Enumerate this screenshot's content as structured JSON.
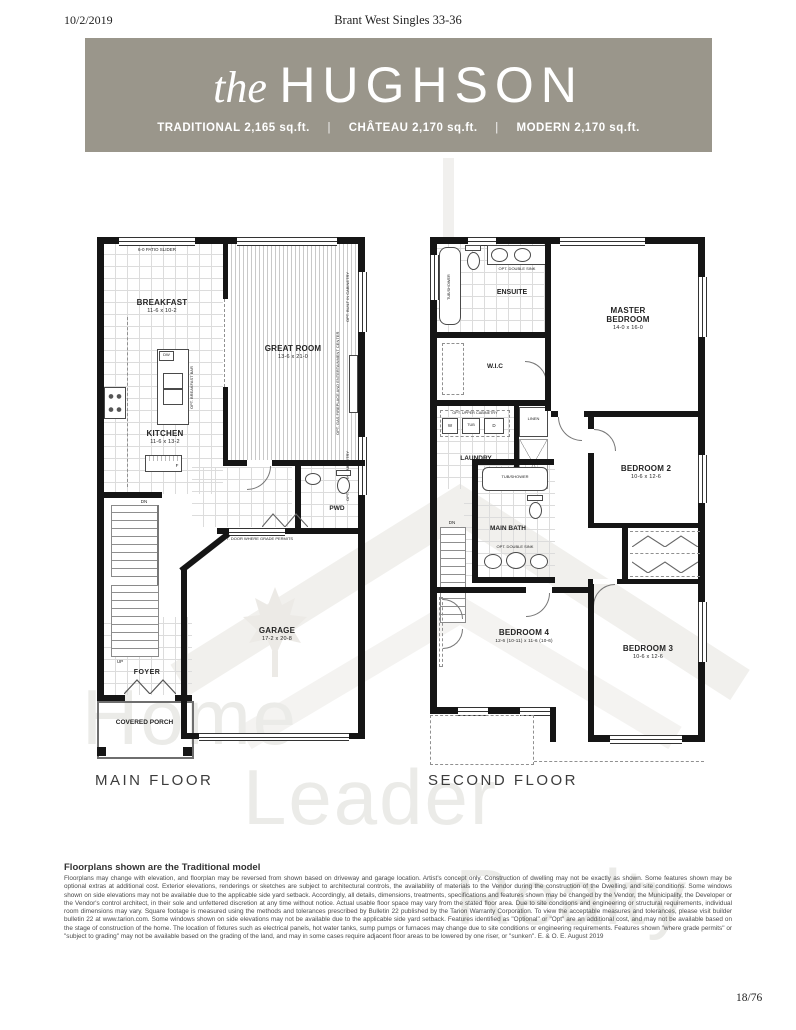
{
  "page": {
    "date": "10/2/2019",
    "header_title": "Brant West Singles 33-36",
    "page_number": "18/76"
  },
  "banner": {
    "title_prefix": "the",
    "title": "HUGHSON",
    "separator": "|",
    "bg_color": "#9a968b",
    "models": [
      {
        "label": "TRADITIONAL",
        "sqft": "2,165 sq.ft."
      },
      {
        "label": "CHÂTEAU",
        "sqft": "2,170 sq.ft."
      },
      {
        "label": "MODERN",
        "sqft": "2,170 sq.ft."
      }
    ]
  },
  "main_floor": {
    "label": "MAIN FLOOR",
    "rooms": {
      "breakfast": {
        "name": "BREAKFAST",
        "dims": "11-6 x 10-2"
      },
      "great_room": {
        "name": "GREAT ROOM",
        "dims": "13-6 x 21-0"
      },
      "kitchen": {
        "name": "KITCHEN",
        "dims": "11-6 x 13-2"
      },
      "powder": {
        "name": "PWD"
      },
      "foyer": {
        "name": "FOYER"
      },
      "covered_porch": {
        "name": "COVERED PORCH"
      },
      "garage": {
        "name": "GARAGE",
        "dims": "17-2 x 20-8"
      }
    },
    "annotations": {
      "patio_slider": "6-0 PATIO SLIDER",
      "opt_breakfast_bar": "OPT. BREAKFAST BAR",
      "opt_built_in_cabinetry": "OPT. BUILT IN CABINETRY",
      "opt_fireplace": "OPT. GAS FIREPLACE AND ENTERTAINMENT CENTER",
      "opt_door_grade": "OPT. DOOR WHERE GRADE PERMITS",
      "dishwasher": "DW",
      "fridge": "F",
      "down": "DN",
      "up": "UP"
    }
  },
  "second_floor": {
    "label": "SECOND FLOOR",
    "rooms": {
      "ensuite": {
        "name": "ENSUITE"
      },
      "master": {
        "name": "MASTER BEDROOM",
        "dims": "14-0 x 16-0"
      },
      "wic": {
        "name": "W.I.C"
      },
      "laundry": {
        "name": "LAUNDRY"
      },
      "linen": {
        "name": "LINEN"
      },
      "bedroom2": {
        "name": "BEDROOM 2",
        "dims": "10-6 x 12-6"
      },
      "main_bath": {
        "name": "MAIN BATH"
      },
      "bedroom4": {
        "name": "BEDROOM 4",
        "dims": "12-6 (10-11) x 11-6 (10-6)"
      },
      "bedroom3": {
        "name": "BEDROOM 3",
        "dims": "10-6 x 12-6"
      }
    },
    "annotations": {
      "tub_shower": "TUB/SHOWER",
      "opt_double_sink": "OPT. DOUBLE SINK",
      "opt_upper_cabinetry": "OPT. UPPER CABINETRY",
      "washer": "W",
      "tub": "TUB",
      "dryer": "D",
      "down": "DN"
    }
  },
  "watermark": {
    "words": [
      "Home",
      "Leader",
      "Realty"
    ],
    "color": "#ebebe8"
  },
  "disclaimer": {
    "heading": "Floorplans shown are the Traditional model",
    "body": "Floorplans may change with elevation, and floorplan may be reversed from shown based on driveway and garage location. Artist's concept only. Construction of dwelling may not be exactly as shown. Some features shown may be optional extras at additional cost. Exterior elevations, renderings or sketches are subject to architectural controls, the availability of materials to the Vendor during the construction of the Dwelling, and site conditions. Some windows shown on side elevations may not be available due to the applicable side yard setback. Accordingly, all details, dimensions, treatments, specifications and features shown may be changed by the Vendor, the Municipality, the Developer or the Vendor's control architect, in their sole and unfettered discretion at any time without notice. Actual usable floor space may vary from the stated floor area. Due to site conditions and engineering or structural requirements, individual room dimensions may vary. Square footage is measured using the methods and tolerances prescribed by Bulletin 22 published by the Tarion Warranty Corporation. To view the acceptable measures and tolerances, please visit builder bulletin 22 at www.tarion.com. Some windows shown on side elevations may not be available due to the applicable side yard setback. Features identified as \"Optional\" or \"Opt\" are an additional cost, and may not be available based on the stage of construction of the home. The location of fixtures such as electrical panels, hot water tanks, sump pumps or furnaces may change due to site conditions or engineering requirements. Features shown \"where grade permits\" or \"subject to grading\" may not be available based on the grading of the land, and may in some cases require adjacent floor areas to be lowered by one riser, or \"sunken\". E. & O. E. August 2019"
  }
}
